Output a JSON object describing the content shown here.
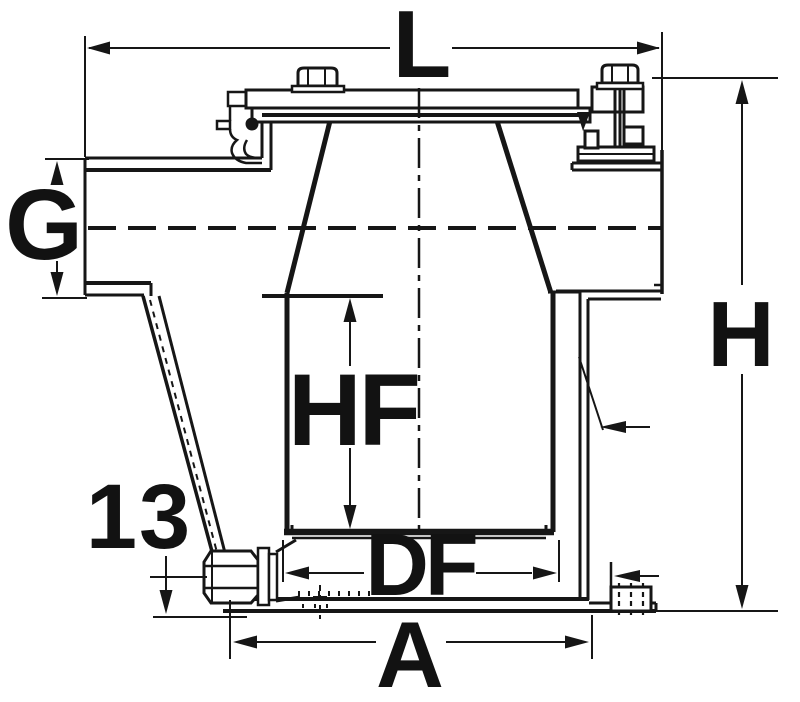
{
  "canvas": {
    "background": "#ffffff",
    "ink": "#161616"
  },
  "labels": {
    "overall_width": "L",
    "inlet_port": "G",
    "overall_height": "H",
    "filter_height": "HF",
    "filter_diameter": "DF",
    "base_width": "A",
    "drain_offset": "13"
  }
}
